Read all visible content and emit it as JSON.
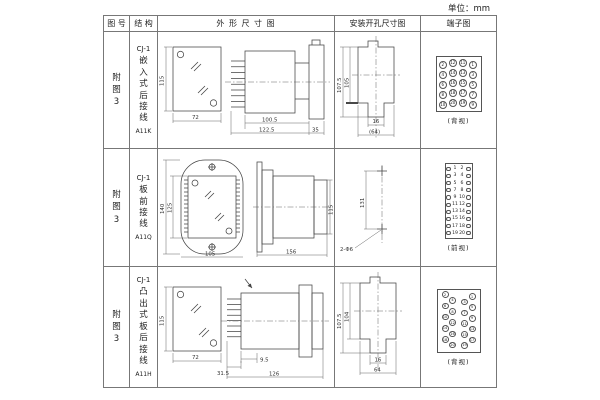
{
  "unit_label": "单位：mm",
  "headers": [
    "图 号",
    "结 构",
    "外 形 尺 寸 图",
    "安装开孔尺寸图",
    "端子图"
  ],
  "rows": [
    {
      "fig_no": "附图3",
      "model": "CJ-1",
      "mount_desc": "嵌入式后接线",
      "code": "A11K",
      "outline": {
        "front_h": "115",
        "front_w": "72",
        "body_l": "100.5",
        "total_l": "122.5",
        "flange_d": "35"
      },
      "install": {
        "outer_h": "107.5",
        "inner_h": "105",
        "notch_w": "16",
        "hole_w": "(64)"
      },
      "terminal": {
        "view_label": "(背视)",
        "grid": [
          [
            2,
            12,
            11,
            1
          ],
          [
            4,
            14,
            13,
            3
          ],
          [
            6,
            16,
            15,
            5
          ],
          [
            8,
            18,
            17,
            7
          ],
          [
            10,
            20,
            19,
            9
          ]
        ]
      }
    },
    {
      "fig_no": "附图3",
      "model": "CJ-1",
      "mount_desc": "板前接线",
      "code": "A11Q",
      "outline": {
        "front_h": "140",
        "front_h2": "125",
        "front_w": "105",
        "side_l": "156",
        "side_h": "115"
      },
      "install": {
        "pitch": "131",
        "hole_label": "2-Φ6"
      },
      "terminal": {
        "view_label": "(前视)",
        "pairs": [
          [
            1,
            2
          ],
          [
            3,
            4
          ],
          [
            5,
            6
          ],
          [
            7,
            8
          ],
          [
            9,
            10
          ],
          [
            11,
            12
          ],
          [
            13,
            14
          ],
          [
            15,
            16
          ],
          [
            17,
            18
          ],
          [
            19,
            20
          ]
        ]
      }
    },
    {
      "fig_no": "附图3",
      "model": "CJ-1",
      "mount_desc": "凸出式板后接线",
      "code": "A11H",
      "outline": {
        "front_h": "115",
        "front_w": "72",
        "pin_l": "31.5",
        "gap": "9.5",
        "total_l": "126"
      },
      "install": {
        "outer_h": "107.5",
        "inner_h": "104",
        "notch_w": "16",
        "hole_w": "64"
      },
      "terminal": {
        "view_label": "(背视)",
        "left": [
          2,
          4,
          6,
          8,
          10,
          12,
          14,
          16,
          18,
          20
        ],
        "right": [
          1,
          3,
          5,
          7,
          9,
          11,
          13,
          15,
          17,
          19
        ]
      }
    }
  ]
}
